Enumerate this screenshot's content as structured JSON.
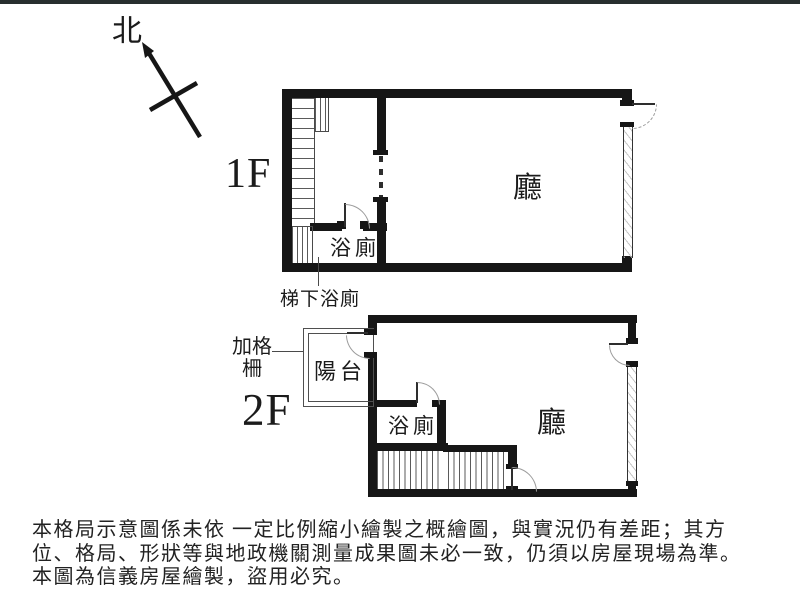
{
  "page": {
    "background": "#ffffff",
    "top_strip_color": "#272e2e",
    "line_color": "#161616"
  },
  "north": {
    "label": "北"
  },
  "floor1": {
    "name_label": "1F",
    "hall_label": "廳",
    "bath_label": "浴廁",
    "under_stair_label": "梯下浴廁"
  },
  "floor2": {
    "name_label": "2F",
    "hall_label": "廳",
    "bath_label": "浴廁",
    "balcony_label": "陽台",
    "grille_label": "加格柵"
  },
  "disclaimer": {
    "line1": "本格局示意圖係未依 一定比例縮小繪製之概繪圖，與實況仍有差距；其方",
    "line2": "位、格局、形狀等與地政機關測量成果圖未必一致，仍須以房屋現場為準。",
    "line3": "本圖為信義房屋繪製，盜用必究。"
  }
}
